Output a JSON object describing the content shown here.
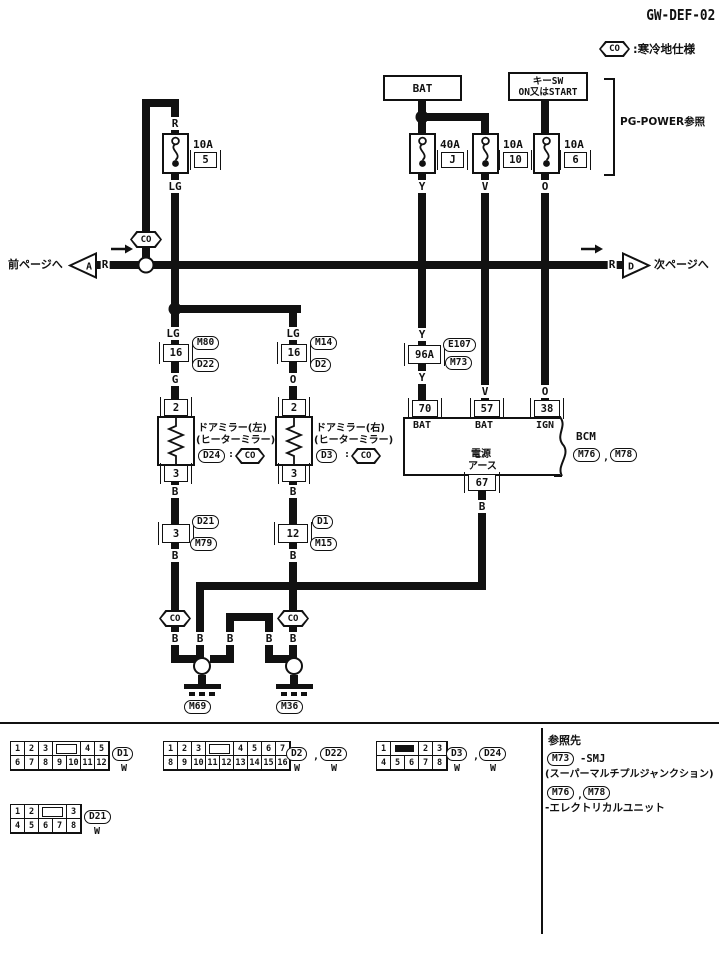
{
  "title": "GW-DEF-02",
  "legend": {
    "text": ":寒冷地仕様"
  },
  "co_label": "CO",
  "nav": {
    "prev": "前ページへ",
    "prev_id": "A",
    "next": "次ページへ",
    "next_id": "D"
  },
  "wire": {
    "r": "R",
    "lg": "LG",
    "g": "G",
    "o": "O",
    "y": "Y",
    "v": "V",
    "b": "B"
  },
  "power": {
    "bat": "BAT",
    "key1": "キーSW",
    "key2": "ON又はSTART",
    "pg": "PG-POWER参照",
    "f5": {
      "a": "10A",
      "id": "5"
    },
    "fj": {
      "a": "40A",
      "id": "J"
    },
    "f10": {
      "a": "10A",
      "id": "10"
    },
    "f6": {
      "a": "10A",
      "id": "6"
    }
  },
  "mid": {
    "m80": "M80",
    "m14": "M14",
    "d22": "D22",
    "d2": "D2",
    "c16": "16",
    "pin2": "2",
    "pin3": "3",
    "mirror_left1": "ドアミラー(左)",
    "mirror_left2": "(ヒーターミラー)",
    "mirror_right1": "ドアミラー(右)",
    "mirror_right2": "(ヒーターミラー)",
    "d24": "D24",
    "d3": "D3",
    "d21": "D21",
    "m79": "M79",
    "c3": "3",
    "d1": "D1",
    "m15": "M15",
    "c12": "12"
  },
  "bcm": {
    "e107": "E107",
    "c96a": "96A",
    "m73": "M73",
    "p70": "70",
    "p57": "57",
    "p38": "38",
    "bat": "BAT",
    "ign": "IGN",
    "name": "BCM",
    "m76": "M76",
    "m78": "M78",
    "gnd1": "電源",
    "gnd2": "アース",
    "p67": "67"
  },
  "ground": {
    "m69": "M69",
    "m36": "M36"
  },
  "punct": {
    "comma": ",",
    "dot": ".",
    "colon": ":"
  },
  "connectors": [
    {
      "ids": [
        "D1"
      ],
      "color": "W",
      "slot": "outline",
      "top_pre": [
        "1",
        "2",
        "3"
      ],
      "top_post": [
        "4",
        "5"
      ],
      "bottom": [
        "6",
        "7",
        "8",
        "9",
        "10",
        "11",
        "12"
      ]
    },
    {
      "ids": [
        "D2",
        "D22"
      ],
      "color": "W",
      "slot": "outline",
      "top_pre": [
        "1",
        "2",
        "3"
      ],
      "top_post": [
        "4",
        "5",
        "6",
        "7"
      ],
      "bottom": [
        "8",
        "9",
        "10",
        "11",
        "12",
        "13",
        "14",
        "15",
        "16"
      ]
    },
    {
      "ids": [
        "D3",
        "D24"
      ],
      "color": "W",
      "slot": "filled",
      "top_pre": [
        "1"
      ],
      "top_post": [
        "2",
        "3"
      ],
      "bottom": [
        "4",
        "5",
        "6",
        "7",
        "8"
      ]
    },
    {
      "ids": [
        "D21"
      ],
      "color": "W",
      "slot": "outline",
      "top_pre": [
        "1",
        "2"
      ],
      "top_post": [
        "3"
      ],
      "bottom": [
        "4",
        "5",
        "6",
        "7",
        "8"
      ]
    }
  ],
  "reference": {
    "heading": "参照先",
    "m73": "M73",
    "smj": "-SMJ",
    "smj_full": "(スーパーマルチプルジャンクション)",
    "m76": "M76",
    "m78": "M78",
    "unit": "-エレクトリカルユニット"
  }
}
